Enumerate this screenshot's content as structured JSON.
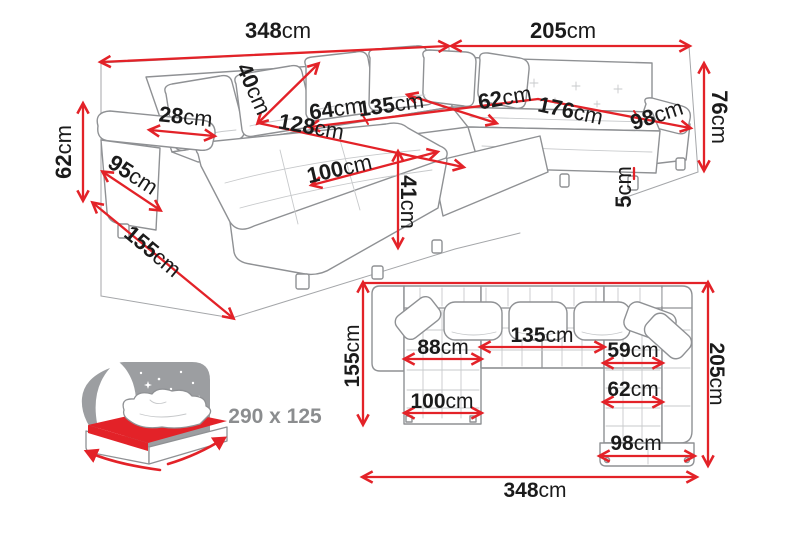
{
  "colors": {
    "dimension_red": "#e32228",
    "outline_gray": "#8f9194",
    "label_black": "#1b1b1b",
    "icon_gray": "#9c9ea1",
    "sleeping_text_gray": "#8b8d8f",
    "background": "#ffffff"
  },
  "perspective": {
    "back_width_left": {
      "value": "348",
      "unit": "cm"
    },
    "back_width_right": {
      "value": "205",
      "unit": "cm"
    },
    "armrest_height": {
      "value": "62",
      "unit": "cm"
    },
    "armrest_depth": {
      "value": "95",
      "unit": "cm"
    },
    "chaise_length": {
      "value": "155",
      "unit": "cm"
    },
    "armrest_top_width": {
      "value": "28",
      "unit": "cm"
    },
    "backrest_depth": {
      "value": "40",
      "unit": "cm"
    },
    "seat_segment_left": {
      "value": "64",
      "unit": "cm"
    },
    "seat_segment_mid": {
      "value": "135",
      "unit": "cm"
    },
    "corner_segment": {
      "value": "62",
      "unit": "cm"
    },
    "seat_segment_right": {
      "value": "176",
      "unit": "cm"
    },
    "arm_segment": {
      "value": "98",
      "unit": "cm"
    },
    "seat_depth": {
      "value": "128",
      "unit": "cm"
    },
    "chaise_width": {
      "value": "100",
      "unit": "cm"
    },
    "seat_height": {
      "value": "41",
      "unit": "cm"
    },
    "leg_height": {
      "value": "5",
      "unit": "cm"
    },
    "side_height": {
      "value": "76",
      "unit": "cm"
    }
  },
  "plan": {
    "depth_left": {
      "value": "155",
      "unit": "cm"
    },
    "chaise_seat_width": {
      "value": "88",
      "unit": "cm"
    },
    "middle_seat_width": {
      "value": "135",
      "unit": "cm"
    },
    "right_seat_width": {
      "value": "59",
      "unit": "cm"
    },
    "depth_right": {
      "value": "205",
      "unit": "cm"
    },
    "right_seat_depth": {
      "value": "62",
      "unit": "cm"
    },
    "chaise_total_width": {
      "value": "100",
      "unit": "cm"
    },
    "right_arm_width": {
      "value": "98",
      "unit": "cm"
    },
    "total_width": {
      "value": "348",
      "unit": "cm"
    }
  },
  "sleeping_area": {
    "dimensions": "290 x 125"
  }
}
